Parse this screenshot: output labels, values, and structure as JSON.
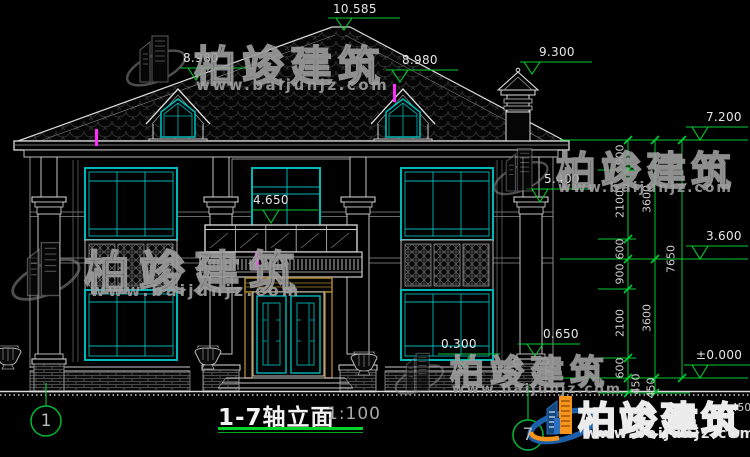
{
  "drawing": {
    "title": "1-7轴立面",
    "scale": "1:100",
    "axis_markers": [
      "1",
      "7"
    ],
    "elevation_labels": [
      "10.585",
      "8.980",
      "8.980",
      "9.300",
      "7.200",
      "5.400",
      "4.650",
      "3.600",
      "0.650",
      "0.300",
      "±0.000"
    ],
    "dim_chains": {
      "inner": [
        "900",
        "2100",
        "600",
        "900",
        "2100",
        "600",
        "450"
      ],
      "middle": [
        "3600",
        "3600",
        "450"
      ],
      "total": "7650",
      "grade": "450"
    }
  },
  "watermark": {
    "brand": "柏竣建筑",
    "url": "www.baijunjz.com"
  },
  "colors": {
    "line": "#dcdcdc",
    "green": "#00cc33",
    "cyan": "#00b8b8",
    "magenta": "#ff2bff",
    "door_frame": "#a5812c",
    "logo_blue": "#1b5ea9",
    "logo_orange": "#f7941d"
  }
}
